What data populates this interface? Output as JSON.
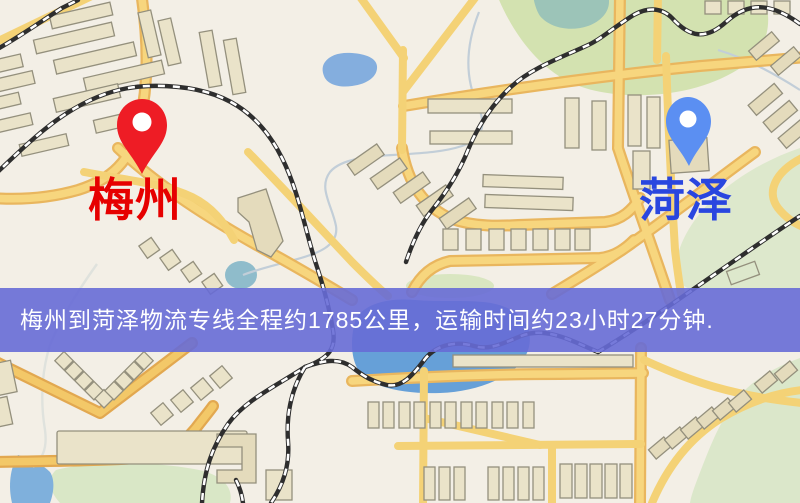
{
  "map": {
    "markers": [
      {
        "id": "meizhou",
        "label": "梅州",
        "pin": "red"
      },
      {
        "id": "heze",
        "label": "菏泽",
        "pin": "blue"
      }
    ],
    "banner": {
      "text": "梅州到菏泽物流专线全程约1785公里，运输时间约23小时27分钟."
    }
  },
  "colors": {
    "pin_red": "#ee1c25",
    "pin_blue": "#5b8ff2",
    "label_red": "#e60000",
    "label_blue": "#2946df",
    "banner_bg": "rgba(103,107,214,0.9)",
    "banner_text": "#ffffff",
    "road_yellow": "#f4d276",
    "road_orange": "#f3c868",
    "water_blue": "#66a0d8",
    "park_green": "#d9e6c1",
    "building_beige": "#eae3c9",
    "railway_dark": "#2e2e2e",
    "map_background": "#f3efe6"
  }
}
